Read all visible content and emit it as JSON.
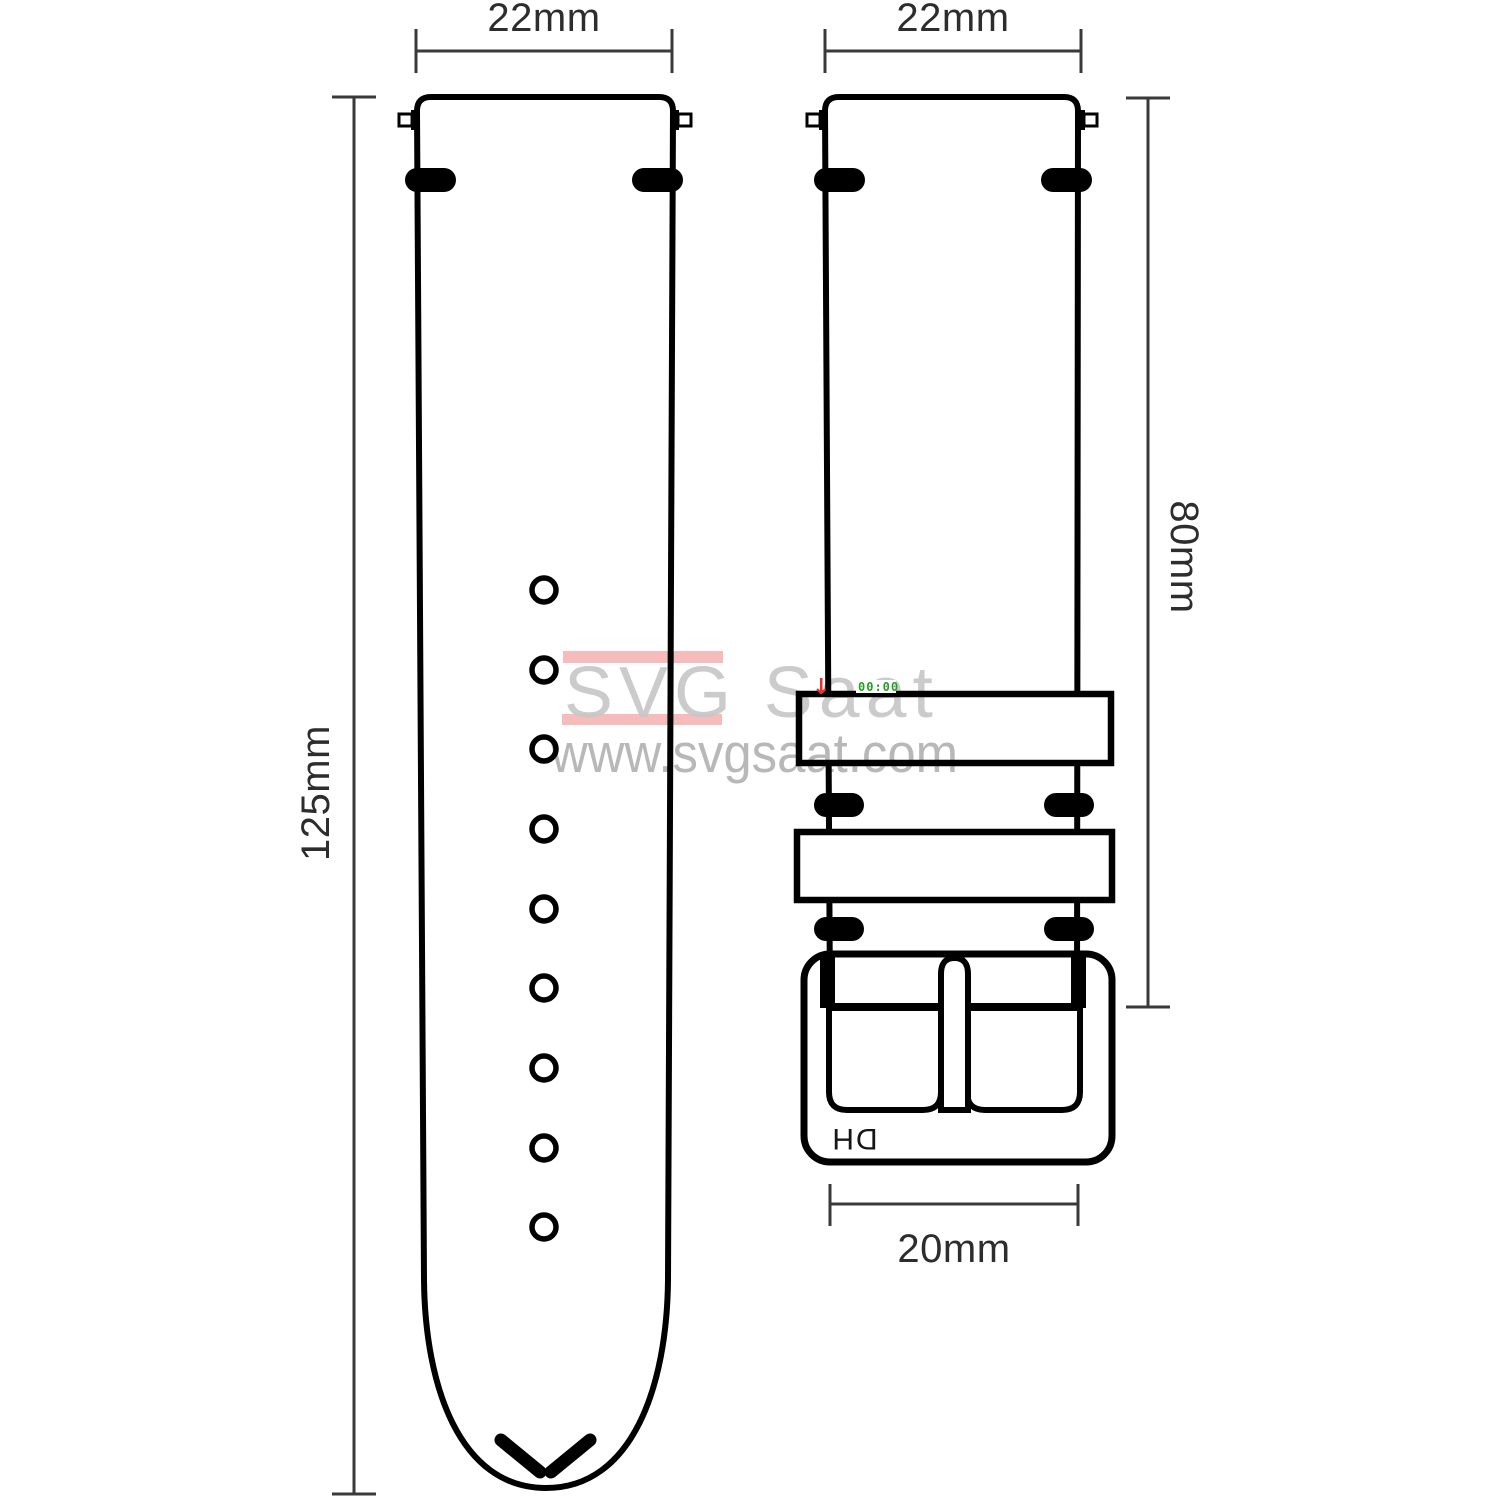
{
  "labels": {
    "long_strap_width": "22mm",
    "short_strap_width": "22mm",
    "long_strap_length": "125mm",
    "short_strap_length": "80mm",
    "buckle_width": "20mm"
  },
  "buckle": {
    "logo": "DH"
  },
  "watermark": {
    "brand": "SVG Saat",
    "url": "www.svgsaat.com",
    "counter": "00:00",
    "arrow": "↓"
  },
  "colors": {
    "line": "#000000",
    "dimension": "#3a3a3a",
    "watermark_gray": "#c6c6c6",
    "url_gray": "#acacac",
    "red_bar": "#ee8585",
    "artifact_red": "#e03434",
    "artifact_green": "#23a123"
  }
}
